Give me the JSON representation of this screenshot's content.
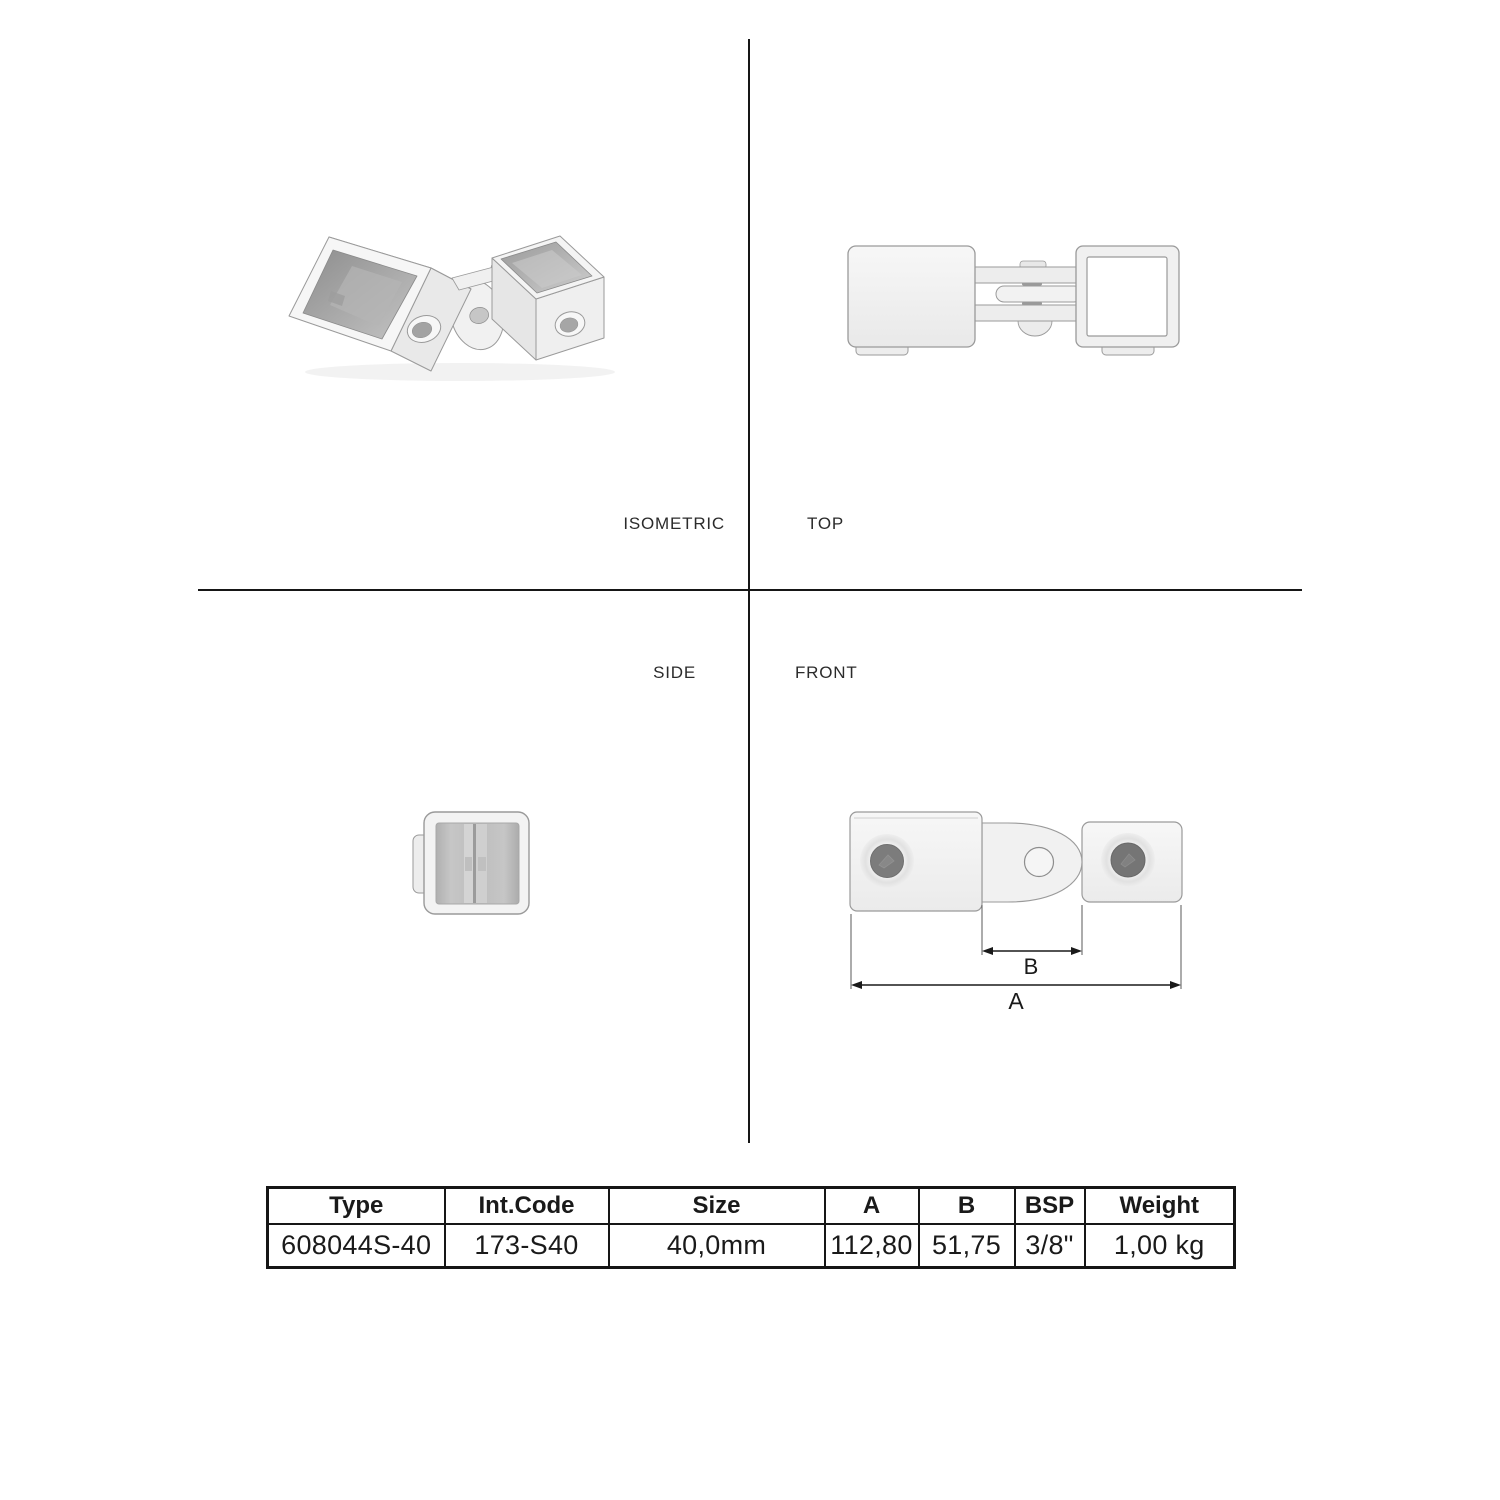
{
  "views": {
    "isometric": {
      "label": "ISOMETRIC"
    },
    "top": {
      "label": "TOP"
    },
    "side": {
      "label": "SIDE"
    },
    "front": {
      "label": "FRONT"
    }
  },
  "dimensions": {
    "a_label": "A",
    "b_label": "B"
  },
  "table": {
    "columns": [
      "Type",
      "Int.Code",
      "Size",
      "A",
      "B",
      "BSP",
      "Weight"
    ],
    "rows": [
      [
        "608044S-40",
        "173-S40",
        "40,0mm",
        "112,80",
        "51,75",
        "3/8\"",
        "1,00 kg"
      ]
    ]
  },
  "colors": {
    "line": "#161616",
    "outline": "#9a9a9a",
    "part_fill": "#f2f2f2",
    "hole_dark": "#7c7c7c",
    "background": "#ffffff"
  }
}
